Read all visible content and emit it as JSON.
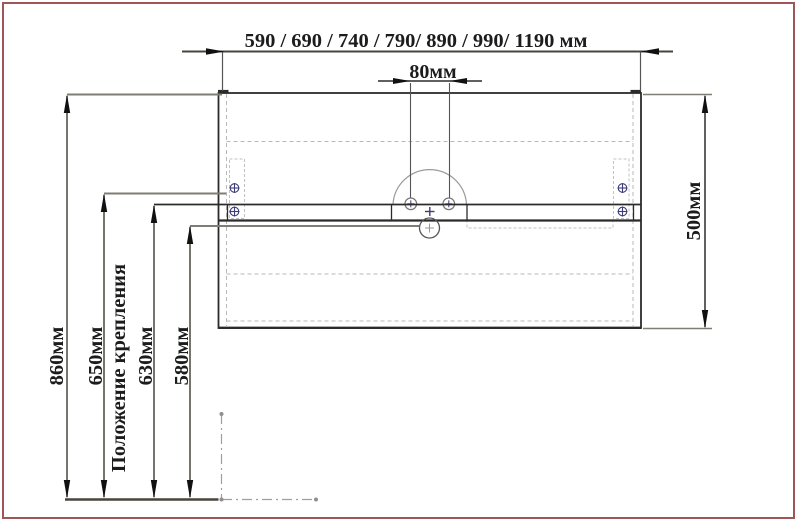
{
  "drawing": {
    "top_width_label": "590 / 690 / 740 / 790/ 890 / 990/ 1190 мм",
    "hole_spacing_label": "80мм",
    "cabinet_height_label": "500мм",
    "overall_height_label": "860мм",
    "mounting_height_label": "650мм",
    "mounting_position_label": "Положение крепления",
    "upper_edge_height_label": "630мм",
    "drain_height_label": "580мм"
  },
  "colors": {
    "frame_border": "#a05656",
    "drawing_line": "#2b2b2b",
    "dim_line": "#55514a",
    "thick_dim_line": "#4a443c",
    "pointer_line": "#807d75",
    "dashed_line": "#b8b8b8",
    "screw_symbol": "#3c3c78",
    "arc_line": "#9a9a9a",
    "arrow_fill": "#111111",
    "centerline": "#9f9f9f"
  }
}
